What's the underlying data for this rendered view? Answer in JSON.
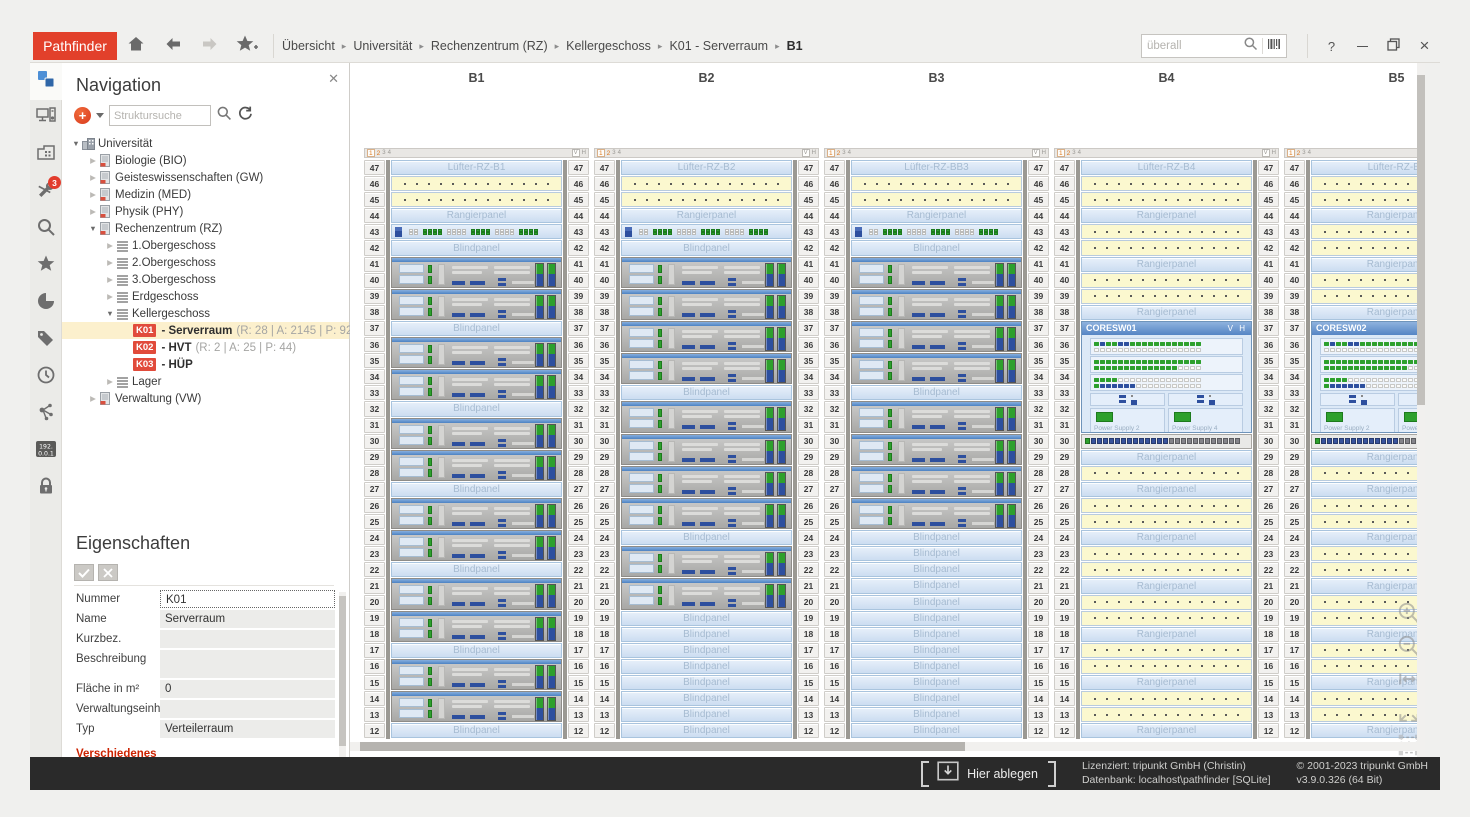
{
  "titlebar": {
    "logo": "Pathfinder",
    "breadcrumb": [
      "Übersicht",
      "Universität",
      "Rechenzentrum (RZ)",
      "Kellergeschoss",
      "K01 - Serverraum",
      "B1"
    ],
    "search_placeholder": "überall",
    "help": "?"
  },
  "sidebar": {
    "badge": "3",
    "ip_label": [
      "192.",
      "0.0.1"
    ],
    "icons": [
      "navigation",
      "hardware",
      "room-plan",
      "tools",
      "search",
      "favorites",
      "pie-chart",
      "tags",
      "history",
      "topology",
      "ip-address",
      "lock"
    ]
  },
  "navigation": {
    "title": "Navigation",
    "search_placeholder": "Struktursuche",
    "tree": [
      {
        "level": 0,
        "arrow": "expanded",
        "icon": "building",
        "label": "Universität"
      },
      {
        "level": 1,
        "arrow": "collapsed",
        "icon": "dept",
        "label": "Biologie (BIO)"
      },
      {
        "level": 1,
        "arrow": "collapsed",
        "icon": "dept",
        "label": "Geisteswissenschaften (GW)"
      },
      {
        "level": 1,
        "arrow": "collapsed",
        "icon": "dept",
        "label": "Medizin (MED)"
      },
      {
        "level": 1,
        "arrow": "collapsed",
        "icon": "dept",
        "label": "Physik (PHY)"
      },
      {
        "level": 1,
        "arrow": "expanded",
        "icon": "dept",
        "label": "Rechenzentrum (RZ)"
      },
      {
        "level": 2,
        "arrow": "collapsed",
        "icon": "floor",
        "label": "1.Obergeschoss"
      },
      {
        "level": 2,
        "arrow": "collapsed",
        "icon": "floor",
        "label": "2.Obergeschoss"
      },
      {
        "level": 2,
        "arrow": "collapsed",
        "icon": "floor",
        "label": "3.Obergeschoss"
      },
      {
        "level": 2,
        "arrow": "collapsed",
        "icon": "floor",
        "label": "Erdgeschoss"
      },
      {
        "level": 2,
        "arrow": "expanded",
        "icon": "floor",
        "label": "Kellergeschoss"
      },
      {
        "level": 3,
        "badge": "K01",
        "label": "- Serverraum",
        "detail": "(R: 28 | A: 2145 | P: 927)",
        "selected": true
      },
      {
        "level": 3,
        "badge": "K02",
        "label": "- HVT",
        "detail": "(R: 2 | A: 25 | P: 44)"
      },
      {
        "level": 3,
        "badge": "K03",
        "label": "- HÜP"
      },
      {
        "level": 2,
        "arrow": "collapsed",
        "icon": "floor",
        "label": "Lager"
      },
      {
        "level": 1,
        "arrow": "collapsed",
        "icon": "dept",
        "label": "Verwaltung (VW)"
      }
    ]
  },
  "properties": {
    "title": "Eigenschaften",
    "fields": [
      {
        "label": "Nummer",
        "value": "K01",
        "focused": true
      },
      {
        "label": "Name",
        "value": "Serverraum"
      },
      {
        "label": "Kurzbez.",
        "value": ""
      },
      {
        "label": "Beschreibung",
        "value": "",
        "tall": true
      },
      {
        "label": "Fläche in m²",
        "value": "0"
      },
      {
        "label": "Verwaltungseinheit",
        "value": ""
      },
      {
        "label": "Typ",
        "value": "Verteilerraum"
      }
    ],
    "section": "Verschiedenes"
  },
  "main": {
    "labels": {
      "rangier": "Rangierpanel",
      "blind": "Blindpanel"
    },
    "tabs": {
      "left": [
        "1",
        "2",
        "3",
        "4"
      ],
      "right": [
        "V",
        "H"
      ]
    },
    "patterns": {
      "switch": "ww gggg wwww gggg wwww gggg",
      "portstrip": "gbbbbbbbbbbbbbssssssssssss"
    },
    "coresw": {
      "vh": "V H",
      "psu": [
        "Power Supply 2",
        "Power Supply 4"
      ],
      "cards": [
        [
          "gbggbbgggggggggggg",
          "wwwwwwwwwwwwwwwwww"
        ],
        [
          "gggggggggggggggggg",
          "ggggggggggggggwwww"
        ],
        [
          "ggggwwwwwwwwwwwwww",
          "gbbbbbbwwwwwwwwwww"
        ]
      ]
    },
    "racks": [
      {
        "name": "B1",
        "units": [
          [
            47,
            1,
            "fan",
            "Lüfter-RZ-B1"
          ],
          [
            46,
            1,
            "patch"
          ],
          [
            45,
            1,
            "patch"
          ],
          [
            44,
            1,
            "rangier"
          ],
          [
            43,
            1,
            "switch"
          ],
          [
            42,
            1,
            "blind"
          ],
          [
            41,
            2,
            "server"
          ],
          [
            39,
            2,
            "server"
          ],
          [
            37,
            1,
            "blind"
          ],
          [
            36,
            2,
            "server"
          ],
          [
            34,
            2,
            "server"
          ],
          [
            32,
            1,
            "blind"
          ],
          [
            31,
            2,
            "server"
          ],
          [
            29,
            2,
            "server"
          ],
          [
            27,
            1,
            "blind"
          ],
          [
            26,
            2,
            "server"
          ],
          [
            24,
            2,
            "server"
          ],
          [
            22,
            1,
            "blind"
          ],
          [
            21,
            2,
            "server"
          ],
          [
            19,
            2,
            "server"
          ],
          [
            17,
            1,
            "blind"
          ],
          [
            16,
            2,
            "server"
          ],
          [
            14,
            2,
            "server"
          ],
          [
            12,
            1,
            "blind"
          ]
        ]
      },
      {
        "name": "B2",
        "units": [
          [
            47,
            1,
            "fan",
            "Lüfter-RZ-B2"
          ],
          [
            46,
            1,
            "patch"
          ],
          [
            45,
            1,
            "patch"
          ],
          [
            44,
            1,
            "rangier"
          ],
          [
            43,
            1,
            "switch"
          ],
          [
            42,
            1,
            "blind"
          ],
          [
            41,
            2,
            "server"
          ],
          [
            39,
            2,
            "server"
          ],
          [
            37,
            2,
            "server"
          ],
          [
            35,
            2,
            "server"
          ],
          [
            33,
            1,
            "blind"
          ],
          [
            32,
            2,
            "server"
          ],
          [
            30,
            2,
            "server"
          ],
          [
            28,
            2,
            "server"
          ],
          [
            26,
            2,
            "server"
          ],
          [
            24,
            1,
            "blind"
          ],
          [
            23,
            2,
            "server"
          ],
          [
            21,
            2,
            "server"
          ],
          [
            19,
            1,
            "blind"
          ],
          [
            18,
            1,
            "blind"
          ],
          [
            17,
            1,
            "blind"
          ],
          [
            16,
            1,
            "blind"
          ],
          [
            15,
            1,
            "blind"
          ],
          [
            14,
            1,
            "blind"
          ],
          [
            13,
            1,
            "blind"
          ],
          [
            12,
            1,
            "blind"
          ]
        ]
      },
      {
        "name": "B3",
        "units": [
          [
            47,
            1,
            "fan",
            "Lüfter-RZ-BB3"
          ],
          [
            46,
            1,
            "patch"
          ],
          [
            45,
            1,
            "patch"
          ],
          [
            44,
            1,
            "rangier"
          ],
          [
            43,
            1,
            "switch"
          ],
          [
            42,
            1,
            "blind"
          ],
          [
            41,
            2,
            "server"
          ],
          [
            39,
            2,
            "server"
          ],
          [
            37,
            2,
            "server"
          ],
          [
            35,
            2,
            "server"
          ],
          [
            33,
            1,
            "blind"
          ],
          [
            32,
            2,
            "server"
          ],
          [
            30,
            2,
            "server"
          ],
          [
            28,
            2,
            "server"
          ],
          [
            26,
            2,
            "server"
          ],
          [
            24,
            1,
            "blind"
          ],
          [
            23,
            1,
            "blind"
          ],
          [
            22,
            1,
            "blind"
          ],
          [
            21,
            1,
            "blind"
          ],
          [
            20,
            1,
            "blind"
          ],
          [
            19,
            1,
            "blind"
          ],
          [
            18,
            1,
            "blind"
          ],
          [
            17,
            1,
            "blind"
          ],
          [
            16,
            1,
            "blind"
          ],
          [
            15,
            1,
            "blind"
          ],
          [
            14,
            1,
            "blind"
          ],
          [
            13,
            1,
            "blind"
          ],
          [
            12,
            1,
            "blind"
          ]
        ]
      },
      {
        "name": "B4",
        "units": [
          [
            47,
            1,
            "fan",
            "Lüfter-RZ-B4"
          ],
          [
            46,
            1,
            "patch"
          ],
          [
            45,
            1,
            "patch"
          ],
          [
            44,
            1,
            "rangier"
          ],
          [
            43,
            1,
            "patch"
          ],
          [
            42,
            1,
            "patch"
          ],
          [
            41,
            1,
            "rangier"
          ],
          [
            40,
            1,
            "patch"
          ],
          [
            39,
            1,
            "patch"
          ],
          [
            38,
            1,
            "rangier"
          ],
          [
            37,
            7,
            "coresw",
            "CORESW01"
          ],
          [
            30,
            1,
            "portstrip"
          ],
          [
            29,
            1,
            "rangier"
          ],
          [
            28,
            1,
            "patch"
          ],
          [
            27,
            1,
            "rangier"
          ],
          [
            26,
            1,
            "patch"
          ],
          [
            25,
            1,
            "patch"
          ],
          [
            24,
            1,
            "rangier"
          ],
          [
            23,
            1,
            "patch"
          ],
          [
            22,
            1,
            "patch"
          ],
          [
            21,
            1,
            "rangier"
          ],
          [
            20,
            1,
            "patch"
          ],
          [
            19,
            1,
            "patch"
          ],
          [
            18,
            1,
            "rangier"
          ],
          [
            17,
            1,
            "patch"
          ],
          [
            16,
            1,
            "patch"
          ],
          [
            15,
            1,
            "rangier"
          ],
          [
            14,
            1,
            "patch"
          ],
          [
            13,
            1,
            "patch"
          ],
          [
            12,
            1,
            "rangier"
          ]
        ]
      },
      {
        "name": "B5",
        "units": [
          [
            47,
            1,
            "fan",
            "Lüfter-RZ-B5"
          ],
          [
            46,
            1,
            "patch"
          ],
          [
            45,
            1,
            "patch"
          ],
          [
            44,
            1,
            "rangier"
          ],
          [
            43,
            1,
            "patch"
          ],
          [
            42,
            1,
            "patch"
          ],
          [
            41,
            1,
            "rangier"
          ],
          [
            40,
            1,
            "patch"
          ],
          [
            39,
            1,
            "patch"
          ],
          [
            38,
            1,
            "rangier"
          ],
          [
            37,
            7,
            "coresw",
            "CORESW02"
          ],
          [
            30,
            1,
            "portstrip"
          ],
          [
            29,
            1,
            "rangier"
          ],
          [
            28,
            1,
            "patch"
          ],
          [
            27,
            1,
            "rangier"
          ],
          [
            26,
            1,
            "patch"
          ],
          [
            25,
            1,
            "patch"
          ],
          [
            24,
            1,
            "rangier"
          ],
          [
            23,
            1,
            "patch"
          ],
          [
            22,
            1,
            "patch"
          ],
          [
            21,
            1,
            "rangier"
          ],
          [
            20,
            1,
            "patch"
          ],
          [
            19,
            1,
            "patch"
          ],
          [
            18,
            1,
            "rangier"
          ],
          [
            17,
            1,
            "patch"
          ],
          [
            16,
            1,
            "patch"
          ],
          [
            15,
            1,
            "rangier"
          ],
          [
            14,
            1,
            "patch"
          ],
          [
            13,
            1,
            "patch"
          ],
          [
            12,
            1,
            "rangier"
          ]
        ]
      }
    ]
  },
  "statusbar": {
    "drop_label": "Hier ablegen",
    "license": [
      "Lizenziert: tripunkt GmbH (Christin)",
      "Datenbank: localhost\\pathfinder [SQLite]"
    ],
    "copyright": [
      "© 2001-2023 tripunkt GmbH",
      "v3.9.0.326 (64 Bit)"
    ]
  }
}
